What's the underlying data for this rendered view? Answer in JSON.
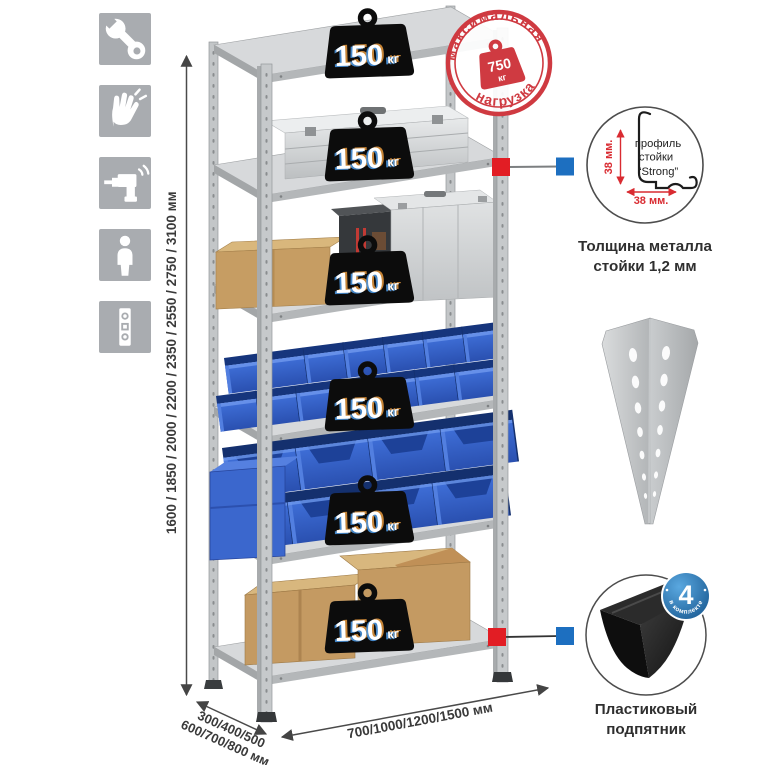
{
  "dimensions": {
    "height_label": "1600 / 1850 / 2000 / 2200 / 2350 / 2550 / 2750 / 3100 мм",
    "depth_label_line1": "300/400/500",
    "depth_label_line2": "600/700/800 мм",
    "width_label": "700/1000/1200/1500 мм"
  },
  "max_load_stamp": {
    "arc_top": "максимальная",
    "arc_bottom": "нагрузка",
    "weight_value": "750",
    "weight_unit": "кг"
  },
  "shelf_badge": {
    "value": "150",
    "unit": "кг",
    "count": 6
  },
  "profile_callout": {
    "dim_vertical": "38 мм.",
    "dim_horizontal": "38 мм.",
    "label_line1": "профиль",
    "label_line2": "стойки",
    "label_line3": "“Strong”",
    "caption_line1": "Толщина металла",
    "caption_line2": "стойки 1,2 мм"
  },
  "foot_callout": {
    "badge_value": "4",
    "badge_arc": "в комплекте",
    "caption_line1": "Пластиковый",
    "caption_line2": "подпятник"
  },
  "colors": {
    "stamp_red": "#cf3a41",
    "marker_red": "#e21d24",
    "marker_blue": "#1d6fc0",
    "bin_blue": "#2f5fc8",
    "badge_black": "#0c0c0c",
    "icon_gray": "#a9acb0"
  }
}
